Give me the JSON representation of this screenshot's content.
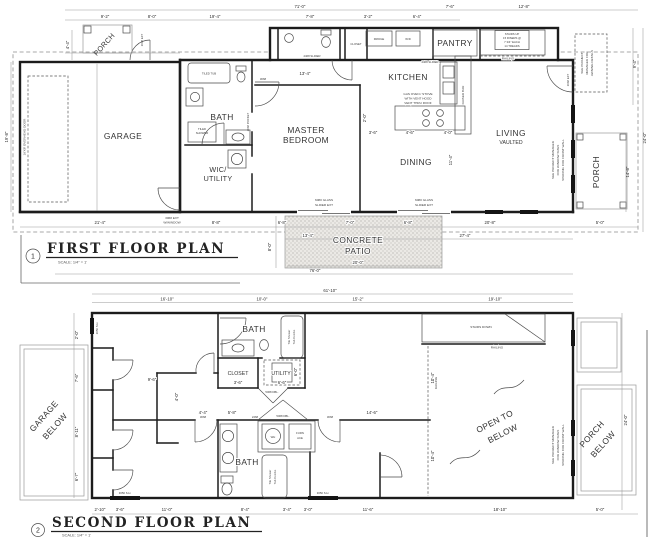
{
  "first_floor": {
    "plan_no": "1",
    "title": "FIRST FLOOR PLAN",
    "scale": "SCALE: 1/4\" = 1'",
    "rooms": {
      "porch": "PORCH",
      "garage": "GARAGE",
      "bath": "BATH",
      "wic1": "WIC/",
      "wic2": "UTILITY",
      "master1": "MASTER",
      "master2": "BEDROOM",
      "kitchen": "KITCHEN",
      "pantry": "PANTRY",
      "dining": "DINING",
      "living": "LIVING",
      "vaulted": "VAULTED",
      "porch_front": "PORCH",
      "patio1": "CONCRETE",
      "patio2": "PATIO"
    },
    "labels": {
      "overhead_door": "16'X8' OVERHEAD DOOR",
      "ext_window1": "3068 EXT",
      "ext_window2": "W/WINDOW",
      "glass_slider1": "6080 GLASS",
      "glass_slider2": "SLIDER EXT",
      "fridge": "FRIDGE",
      "washer_dryer": "W/D",
      "stove1": "GAS OVEN / STOVE",
      "stove2": "WITH VENT HOOD",
      "stove3": "VENT THRU ROOF",
      "raised_bar": "RAISED BAR",
      "stairs1": "STAIRS UP",
      "stairs2": "15 RISERS @",
      "stairs3": "7 3/4\" EACH",
      "stairs4": "14 TREADS",
      "railing": "RAILING",
      "awning1": "SEE PROJECT",
      "awning2": "MANAGER FOR",
      "awning3": "AWNING DETAILS",
      "frontwall1": "SEE PROJECT MANAGER",
      "frontwall2": "FOR WINDOW SIZES",
      "frontwall3": "SPACING FOR FRONT WALL",
      "tiled_tub": "TILED TUB",
      "tiled_shower1": "TILED",
      "tiled_shower2": "SHOWER",
      "closet": "CLOSET",
      "slider_2468": "2468 SLIDER",
      "door_3068": "3068",
      "pocket_2668": "2668 POCKET",
      "door_3068_ext": "3068 EXT"
    },
    "dims": {
      "overall_top": "71'-0\"",
      "top_right": [
        "7'-6\"",
        "12'-8\""
      ],
      "top_segments": [
        "9'-2\"",
        "8'-0\"",
        "19'-4\"",
        "7'-8\"",
        "3'-2\"",
        "6'-4\""
      ],
      "left": [
        "19'-8\"",
        "4'-4\""
      ],
      "right": [
        "9'-4\"",
        "24'-0\"",
        "14'-8\""
      ],
      "bottom": [
        "21'-4\"",
        "8'-8\"",
        "6'-8\"",
        "13'-4\"",
        "7'-0\"",
        "6'-8\"",
        "20'-8\"",
        "5'-0\"",
        "27'-4\"",
        "8'-0\"",
        "20'-0\"",
        "76'-0\""
      ],
      "inner": [
        "13'-4\"",
        "11'-4\"",
        "3'-6\"",
        "4'-6\"",
        "4'-0\"",
        "2'-0\""
      ]
    }
  },
  "second_floor": {
    "plan_no": "2",
    "title": "SECOND FLOOR PLAN",
    "scale": "SCALE: 1/4\" = 1'",
    "rooms": {
      "garage_below1": "GARAGE",
      "garage_below2": "BELOW",
      "bath_top": "BATH",
      "closet": "CLOSET",
      "utility": "UTILITY",
      "bath_bottom": "BATH",
      "water_heater": "WH",
      "furnace1": "FURN",
      "furnace2": "ACE",
      "open_below1": "OPEN TO",
      "open_below2": "BELOW",
      "porch_below1": "PORCH",
      "porch_below2": "BELOW"
    },
    "labels": {
      "stairs_down": "STAIRS DOWN",
      "railing": "RAILING",
      "tub1": "Tile Shower",
      "tub2": "Tub Combo",
      "window_3050": "3050 S.H.",
      "door_5068": "5068 DBL.",
      "door_3068": "3068",
      "door_2468": "2468",
      "frontwall1": "SEE PROJECT MANAGER",
      "frontwall2": "FOR WINDOW SIZES",
      "frontwall3": "SPACING FOR FRONT WALL"
    },
    "dims": {
      "overall_top": "61'-10\"",
      "top_segments": [
        "16'-10\"",
        "10'-0\"",
        "15'-2\"",
        "19'-10\""
      ],
      "left": [
        "2'-0\"",
        "7'-6\"",
        "8'-11\"",
        "6'-7\""
      ],
      "right": [
        "24'-0\""
      ],
      "bottom": [
        "2'-10\"",
        "3'-6\"",
        "11'-0\"",
        "8'-4\"",
        "3'-4\"",
        "3'-0\"",
        "11'-6\"",
        "18'-10\"",
        "5'-0\""
      ],
      "inner": [
        "9'-6\"",
        "4'-0\"",
        "14'-6\"",
        "4'-4\"",
        "5'-8\"",
        "10'-4\"",
        "10'-4\"",
        "3'-6\"",
        "6'-6\"",
        "6'-0\""
      ]
    }
  }
}
